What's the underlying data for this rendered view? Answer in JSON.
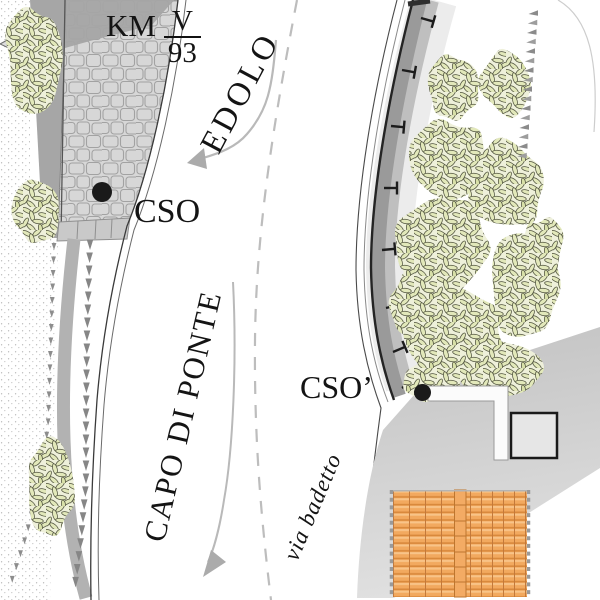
{
  "map": {
    "km_marker": {
      "label": "KM",
      "numerator": "V",
      "denominator": "93"
    },
    "directions": {
      "north": "EDOLO",
      "south": "CAPO DI PONTE"
    },
    "points": {
      "cso": "CSO",
      "cso_prime": "CSO’"
    },
    "street_name": "via badetto",
    "legend_colors": {
      "vegetation": "#e2e8ba",
      "roof_tiles": "#f2a95f",
      "roadway_mid": "#bfbfbf",
      "roadway_dark": "#9a9a9a",
      "guardrail": "#242424",
      "cobblestone": "#d7d7d7",
      "marker_dot": "#1a1a1a",
      "arrow_gray": "#b0b0b0"
    }
  }
}
